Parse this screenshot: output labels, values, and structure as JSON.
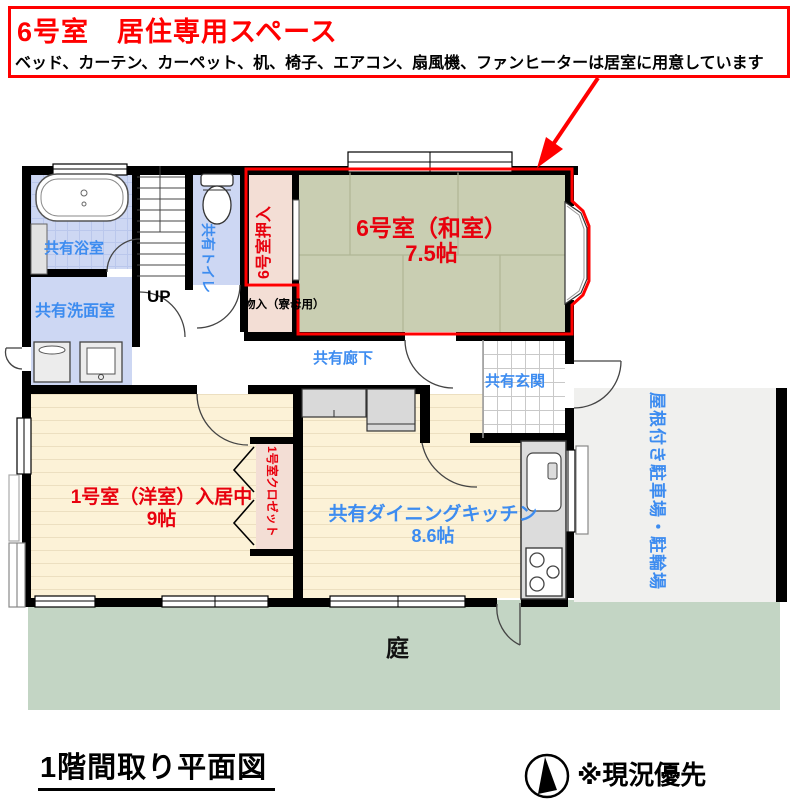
{
  "header": {
    "title": "6号室　居住専用スペース",
    "subtitle": "ベッド、カーテン、カーペット、机、椅子、エアコン、扇風機、ファンヒーターは居室に用意しています"
  },
  "rooms": {
    "bath": {
      "label": "共有浴室"
    },
    "washroom": {
      "label": "共有洗面室"
    },
    "stairs": {
      "label": "UP"
    },
    "toilet": {
      "label": "共有トイレ"
    },
    "room6_closet": {
      "label": "6号室押入"
    },
    "storage": {
      "label": "物入（寮母用）"
    },
    "room6": {
      "name": "6号室（和室）",
      "size": "7.5帖"
    },
    "corridor": {
      "label": "共有廊下"
    },
    "entrance": {
      "label": "共有玄関"
    },
    "room1": {
      "name": "1号室（洋室）入居中",
      "size": "9帖"
    },
    "room1_closet": {
      "label": "1号室クロゼット"
    },
    "dk": {
      "name": "共有ダイニングキッチン",
      "size": "8.6帖"
    },
    "parking": {
      "label": "屋根付き駐車場・駐輪場"
    },
    "garden": {
      "label": "庭"
    }
  },
  "footer": {
    "caption": "1階間取り平面図",
    "note": "※現況優先"
  },
  "icons": {
    "compass": "north-arrow-compass-icon",
    "fixtures": [
      "bathtub-icon",
      "toilet-icon",
      "washer-icon",
      "sink-icon",
      "stove-icon"
    ]
  },
  "colors": {
    "accent_red": "#ff0000",
    "label_red": "#e8000d",
    "label_blue": "#3d8cf0",
    "tatami_green": "#c9ceb2",
    "closet_pink": "#f3ded5",
    "wet_room_blue": "#cdd7f3",
    "floor_cream": "#fcf2d7",
    "garden_green": "#c3d5c4",
    "parking_gray": "#f0f0ee"
  }
}
